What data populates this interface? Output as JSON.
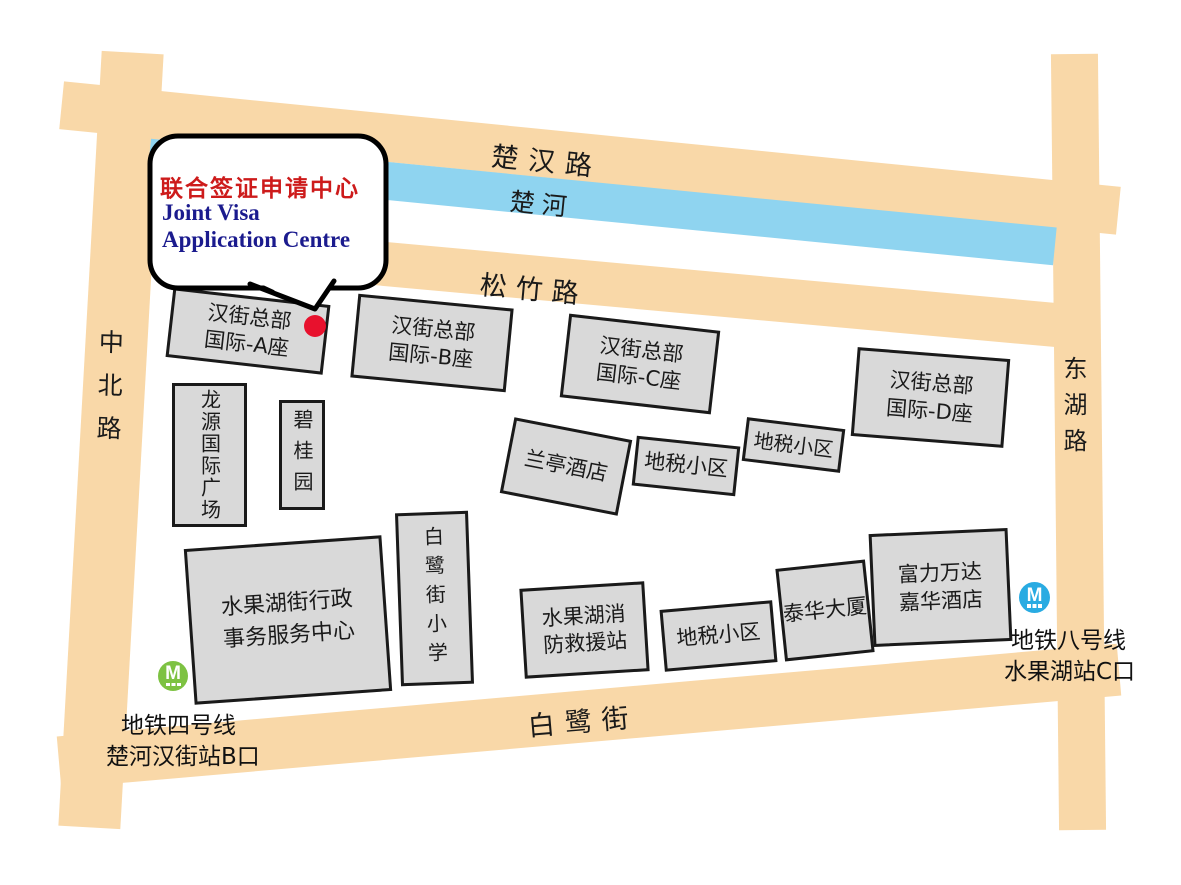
{
  "map": {
    "callout": {
      "title_zh": "联合签证申请中心",
      "title_en_line1": "Joint Visa",
      "title_en_line2": "Application Centre",
      "title_zh_color": "#cd1b1b",
      "title_en_color": "#1b1b8e"
    },
    "roads": {
      "chuhan": "楚汉路",
      "river": "楚河",
      "songzhu": "松竹路",
      "bailu": "白鹭街",
      "zhongbei": "中北路",
      "donghu": "东湖路"
    },
    "buildings": {
      "hanjie_a": {
        "line1": "汉街总部",
        "line2": "国际-A座"
      },
      "hanjie_b": {
        "line1": "汉街总部",
        "line2": "国际-B座"
      },
      "hanjie_c": {
        "line1": "汉街总部",
        "line2": "国际-C座"
      },
      "hanjie_d": {
        "line1": "汉街总部",
        "line2": "国际-D座"
      },
      "longyuan": {
        "line1": "龙源国际广场"
      },
      "biguiyuan": {
        "line1": "碧桂园"
      },
      "lanting": {
        "line1": "兰亭酒店"
      },
      "dishui_upper": {
        "line1": "地税小区"
      },
      "dishui_right": {
        "line1": "地税小区"
      },
      "admin_center": {
        "line1": "水果湖街行政",
        "line2": "事务服务中心"
      },
      "bailu_school": {
        "line1": "白鹭街小学"
      },
      "fire_station": {
        "line1": "水果湖消",
        "line2": "防救援站"
      },
      "dishui_lower": {
        "line1": "地税小区"
      },
      "taihua": {
        "line1": "泰华大厦"
      },
      "fuli_wanda": {
        "line1": "富力万达",
        "line2": "嘉华酒店"
      }
    },
    "metro": {
      "line4": {
        "icon_letter": "M",
        "name": "地铁四号线",
        "exit": "楚河汉街站B口",
        "color": "#7dc242"
      },
      "line8": {
        "icon_letter": "M",
        "name": "地铁八号线",
        "exit": "水果湖站C口",
        "color": "#29abe2"
      }
    },
    "colors": {
      "road": "#f9d8a8",
      "river": "#8fd4f0",
      "building_fill": "#d9d9d9",
      "building_border": "#1a1a1a",
      "location_dot": "#e8112d"
    }
  }
}
